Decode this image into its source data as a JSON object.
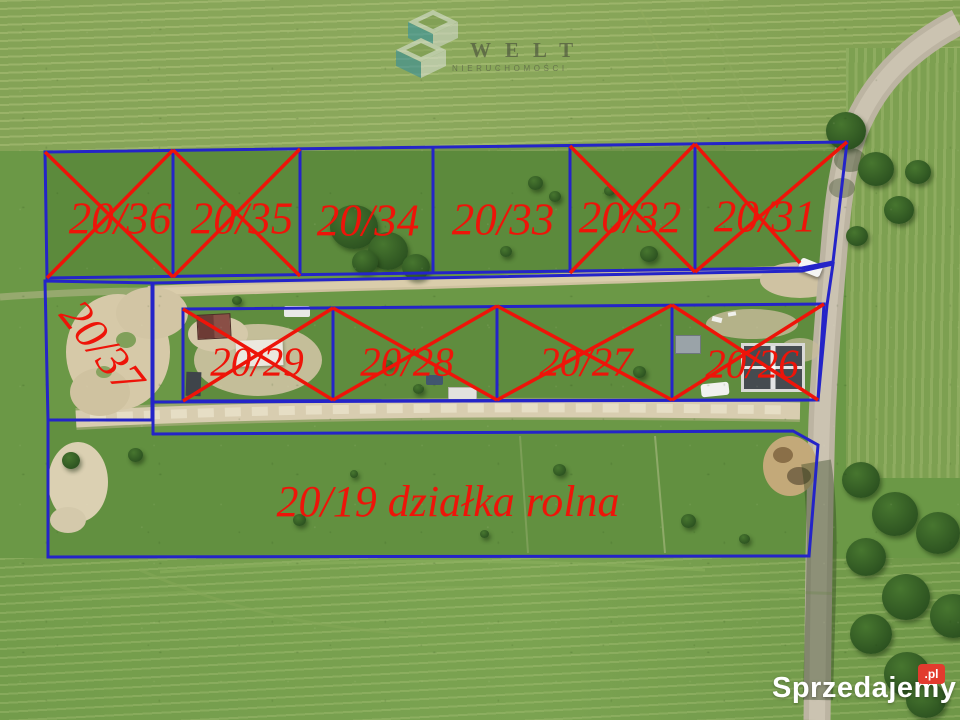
{
  "image": {
    "description": "Aerial drone photo of surveyed building plots for sale with blue parcel boundaries; sold plots are crossed out in red",
    "boundary_color": "#2424c8",
    "marking_color": "#ee1409"
  },
  "plots": [
    {
      "id": "20/36",
      "label": "20/36",
      "crossed": true
    },
    {
      "id": "20/35",
      "label": "20/35",
      "crossed": true
    },
    {
      "id": "20/34",
      "label": "20/34",
      "crossed": false
    },
    {
      "id": "20/33",
      "label": "20/33",
      "crossed": false
    },
    {
      "id": "20/32",
      "label": "20/32",
      "crossed": true
    },
    {
      "id": "20/31",
      "label": "20/31",
      "crossed": true
    },
    {
      "id": "20/37",
      "label": "20/37",
      "crossed": false
    },
    {
      "id": "20/29",
      "label": "20/29",
      "crossed": true
    },
    {
      "id": "20/28",
      "label": "20/28",
      "crossed": true
    },
    {
      "id": "20/27",
      "label": "20/27",
      "crossed": true
    },
    {
      "id": "20/26",
      "label": "20/26",
      "crossed": true
    },
    {
      "id": "20/19",
      "label": "20/19 działka rolna",
      "crossed": false
    }
  ],
  "watermarks": {
    "agency": {
      "name": "WELT",
      "subtitle": "NIERUCHOMOŚCI"
    },
    "portal": {
      "name": "Sprzedajemy",
      "tld": ".pl",
      "badge_color": "#e23b2e"
    }
  }
}
